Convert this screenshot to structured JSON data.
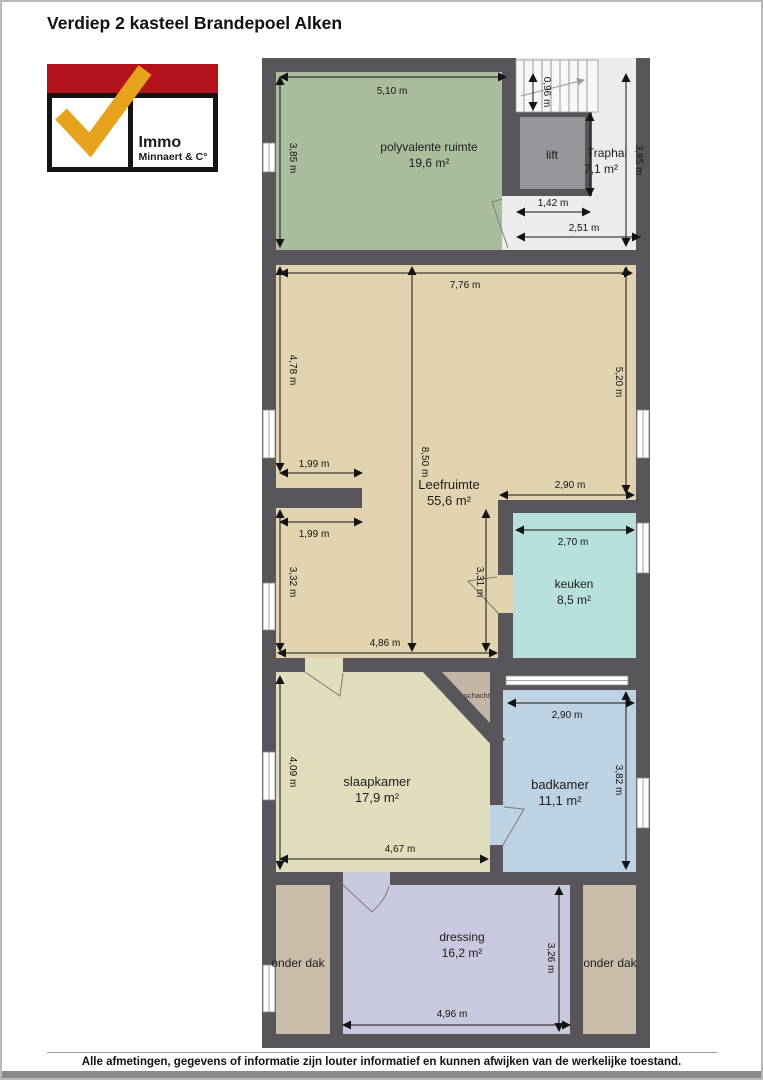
{
  "title": "Verdiep 2 kasteel Brandepoel Alken",
  "logo": {
    "line1": "Immo",
    "line2": "Minnaert & C°"
  },
  "footer": "Alle afmetingen, gegevens of informatie zijn louter informatief en kunnen afwijken van de werkelijke toestand.",
  "colors": {
    "wall": "#59565b",
    "dimension": "#141414",
    "logo_red": "#b5131b",
    "logo_yellow": "#e7a31d",
    "traphal_floor": "#ececec"
  },
  "rooms": [
    {
      "name": "polyvalente ruimte",
      "area": "19,6 m²",
      "color": "#a9bc9b"
    },
    {
      "name": "Traphal",
      "area": "7,1 m²",
      "color": "#ececec"
    },
    {
      "name": "lift",
      "color": "#98969b"
    },
    {
      "name": "Leefruimte",
      "area": "55,6 m²",
      "color": "#e2d3b0"
    },
    {
      "name": "keuken",
      "area": "8,5 m²",
      "color": "#b7dfdb"
    },
    {
      "name": "schacht",
      "color": "#c4b4a4"
    },
    {
      "name": "slaapkamer",
      "area": "17,9 m²",
      "color": "#dfddbb"
    },
    {
      "name": "badkamer",
      "area": "11,1 m²",
      "color": "#bdd2e2"
    },
    {
      "name": "dressing",
      "area": "16,2 m²",
      "color": "#c8c8de"
    },
    {
      "name": "onder dak",
      "color": "#c9bda9"
    },
    {
      "name": "onder dak",
      "color": "#c9bda9"
    }
  ],
  "dims": {
    "poly_width": "5,10 m",
    "poly_height": "3,85 m",
    "stair_width": "0,96 m",
    "lift_width": "1,42 m",
    "traphal_width": "2,51 m",
    "traphal_height": "3,85 m",
    "leef_width": "7,76 m",
    "leef_left_upper": "4,78 m",
    "leef_right": "5,20 m",
    "leef_total_height": "8,50 m",
    "nook_top": "1,99 m",
    "nook_bottom": "1,99 m",
    "leef_to_keuken": "2,90 m",
    "keuken_width": "2,70 m",
    "leef_left_lower": "3,32 m",
    "leef_mid_lower": "3,31 m",
    "leef_bottom_width": "4,86 m",
    "badkamer_width": "2,90 m",
    "slaapkamer_height": "4,09 m",
    "slaapkamer_width": "4,67 m",
    "badkamer_height": "3,82 m",
    "dressing_width": "4,96 m",
    "dressing_height": "3,26 m"
  }
}
